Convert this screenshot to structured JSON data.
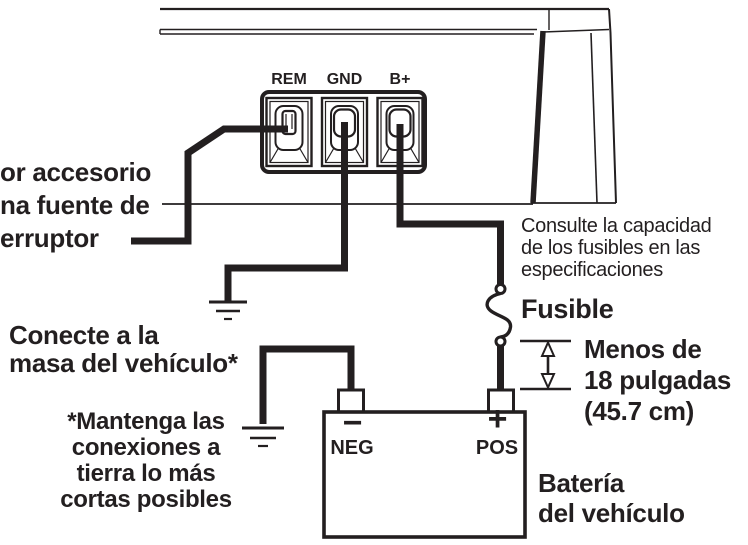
{
  "diagram": {
    "title_hint": "amplifier power wiring diagram",
    "colors": {
      "line": "#231f20",
      "background": "#ffffff"
    },
    "amplifier": {
      "terminals": [
        {
          "label": "REM"
        },
        {
          "label": "GND"
        },
        {
          "label": "B+"
        }
      ]
    },
    "callouts": {
      "remote_source": {
        "lines": [
          "or accesorio",
          "na fuente de",
          "erruptor"
        ]
      },
      "chassis_ground": {
        "lines": [
          "Conecte a la",
          "masa del vehículo*"
        ]
      },
      "ground_note": {
        "lines": [
          "*Mantenga las",
          "conexiones a",
          "tierra lo más",
          "cortas posibles"
        ]
      },
      "fuse_spec": {
        "lines": [
          "Consulte la capacidad",
          "de los fusibles en las",
          "especificaciones"
        ]
      },
      "fuse_label": "Fusible",
      "fuse_distance": {
        "lines": [
          "Menos de",
          "18 pulgadas",
          "(45.7 cm)"
        ]
      },
      "battery_label": {
        "lines": [
          "Batería",
          "del vehículo"
        ]
      }
    },
    "battery": {
      "neg_symbol": "−",
      "neg_label": "NEG",
      "pos_symbol": "+",
      "pos_label": "POS"
    }
  }
}
